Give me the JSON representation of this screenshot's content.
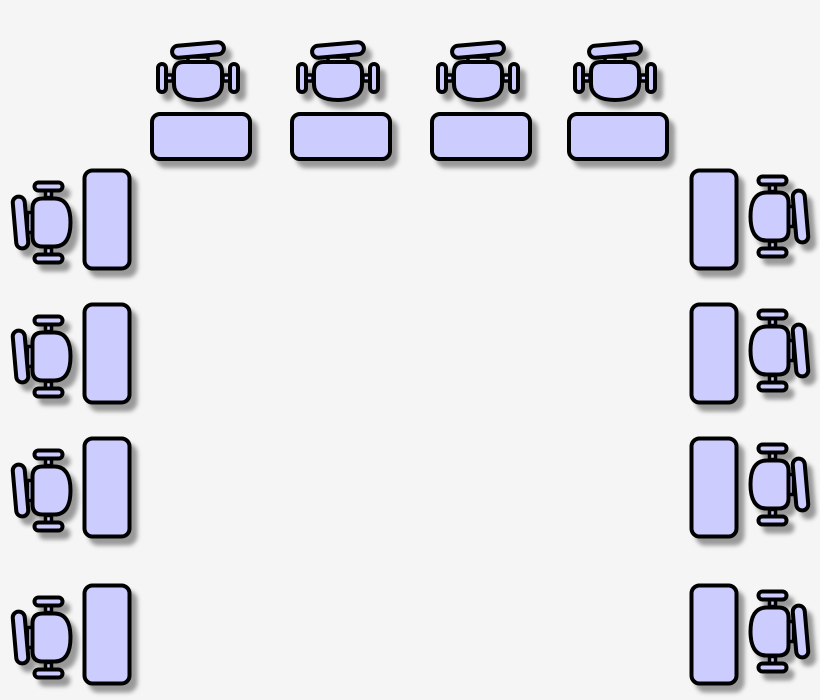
{
  "diagram": {
    "type": "classroom-seating-plan",
    "canvas": {
      "width": 820,
      "height": 700
    },
    "colors": {
      "background": "#f5f5f5",
      "furniture_fill": "#ccccff",
      "outline": "#000000",
      "shadow": "#999999"
    },
    "unit_count": 12,
    "arrangement": "U-shape: 4 units across the top facing down, 4 units on the left side facing right, 4 units on the right side facing left",
    "units": [
      {
        "id": "top-1",
        "side": "top",
        "chair_facing": "down",
        "x": 150,
        "y": 42
      },
      {
        "id": "top-2",
        "side": "top",
        "chair_facing": "down",
        "x": 290,
        "y": 42
      },
      {
        "id": "top-3",
        "side": "top",
        "chair_facing": "down",
        "x": 430,
        "y": 42
      },
      {
        "id": "top-4",
        "side": "top",
        "chair_facing": "down",
        "x": 567,
        "y": 42
      },
      {
        "id": "left-1",
        "side": "left",
        "chair_facing": "right",
        "x": 12,
        "y": 168
      },
      {
        "id": "left-2",
        "side": "left",
        "chair_facing": "right",
        "x": 12,
        "y": 302
      },
      {
        "id": "left-3",
        "side": "left",
        "chair_facing": "right",
        "x": 12,
        "y": 436
      },
      {
        "id": "left-4",
        "side": "left",
        "chair_facing": "right",
        "x": 12,
        "y": 583
      },
      {
        "id": "right-1",
        "side": "right",
        "chair_facing": "left",
        "x": 689,
        "y": 168
      },
      {
        "id": "right-2",
        "side": "right",
        "chair_facing": "left",
        "x": 689,
        "y": 302
      },
      {
        "id": "right-3",
        "side": "right",
        "chair_facing": "left",
        "x": 689,
        "y": 436
      },
      {
        "id": "right-4",
        "side": "right",
        "chair_facing": "left",
        "x": 689,
        "y": 583
      }
    ]
  }
}
